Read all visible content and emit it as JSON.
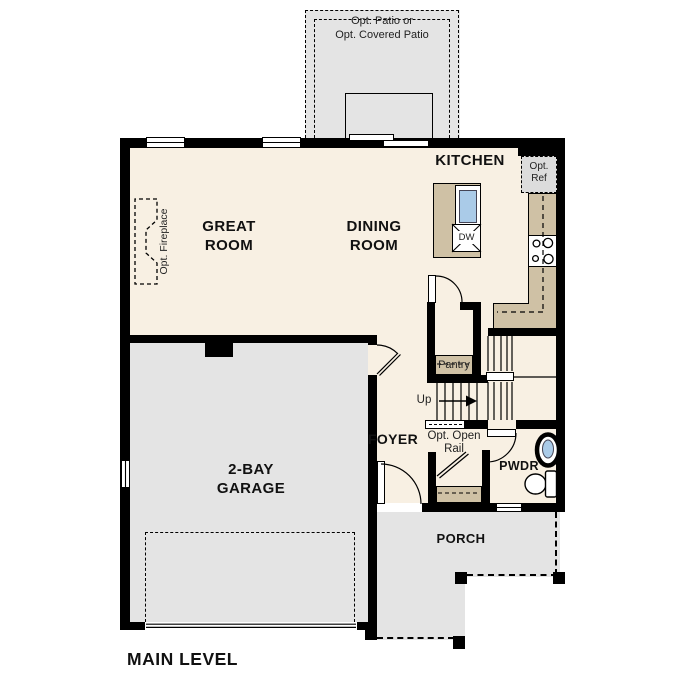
{
  "title": "MAIN LEVEL",
  "colors": {
    "floor_cream": "#f8f0e3",
    "concrete_gray": "#e4e4e4",
    "counter_tan": "#cfc1a5",
    "sink_blue": "#aacbe8",
    "appliance_gray": "#dcdcdc",
    "wall_black": "#000000"
  },
  "rooms": {
    "great_room": {
      "line1": "GREAT",
      "line2": "ROOM"
    },
    "dining_room": {
      "line1": "DINING",
      "line2": "ROOM"
    },
    "kitchen": {
      "label": "KITCHEN"
    },
    "garage": {
      "line1": "2-BAY",
      "line2": "GARAGE"
    },
    "foyer": {
      "label": "FOYER"
    },
    "powder_room": {
      "label": "PWDR"
    },
    "porch": {
      "label": "PORCH"
    },
    "pantry": {
      "label": "Pantry"
    }
  },
  "annotations": {
    "patio": {
      "line1": "Opt. Patio or",
      "line2": "Opt. Covered Patio"
    },
    "fireplace": {
      "label": "Opt. Fireplace"
    },
    "refrigerator": {
      "line1": "Opt.",
      "line2": "Ref"
    },
    "dishwasher": {
      "label": "DW"
    },
    "stairs_up": {
      "label": "Up"
    },
    "open_rail": {
      "line1": "Opt. Open",
      "line2": "Rail"
    }
  }
}
